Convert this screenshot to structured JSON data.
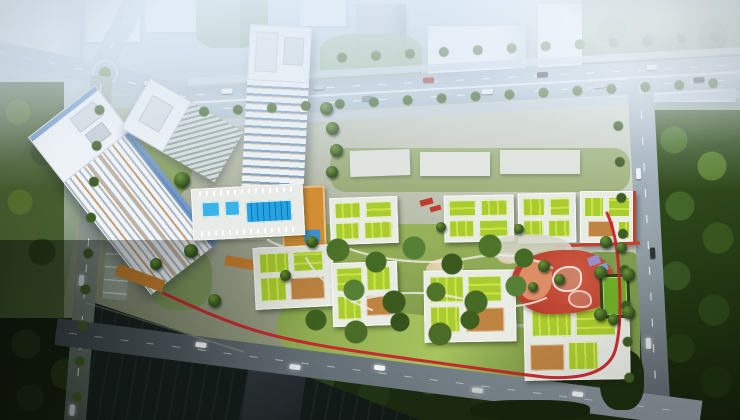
{
  "scene": {
    "type": "aerial-architectural-rendering",
    "description": "Bird's-eye architectural rendering of a residential development: high-rise towers at the north-west, two rows of mid-rise blocks with lime-green roof gardens, a swimming-pool amenity deck, an orange courtyard, a red organic-shaped playground with a green sports court, and a red jogging track looping the gardens; the site is bounded by tree-lined arterial roads with traffic, hazy city blocks to the north, dense forest to the east and a dark lake at the south-west.",
    "features": [
      "background-city-blocks",
      "north-arterial-road",
      "roundabout",
      "west-road",
      "south-road",
      "east-road",
      "high-rise-slab-tower",
      "white-roof-tower",
      "center-tower",
      "swimming-pool-deck",
      "orange-courtyard",
      "green-roof-residential-blocks",
      "central-garden",
      "sand-play-mounds",
      "red-playground",
      "purple-courts",
      "sports-court",
      "jogging-track",
      "lake",
      "dark-office-building",
      "east-forest",
      "west-park",
      "street-trees",
      "cars"
    ]
  },
  "palette": {
    "sky_haze": "#dce9f4",
    "distant_building_light": "#eef2f7",
    "distant_building_shade": "#c0cedd",
    "background_hill_green": "#9db4a0",
    "road_light": "#b4c2cf",
    "road_shade": "#525c63",
    "lane_marking": "#f2f6f9",
    "sidewalk": "#ced9e2",
    "site_ground_light": "#e0e2d9",
    "site_ground_dark": "#5a644c",
    "tower_facade": "#f2f5f8",
    "facade_stripe": "#aeb9c2",
    "tower_glass_blue": "#4a7ab5",
    "tower_accent_tan": "#c59a66",
    "block_white": "#e9ece4",
    "roof_green": "#a9cd2e",
    "roof_green_light": "#cde24a",
    "roof_tan": "#bf8442",
    "pool_blue": "#25a3e0",
    "pool_lane": "#0f6fb6",
    "deck_orange": "#d28e33",
    "accent_tile_blue": "#3f8fc9",
    "play_red": "#b9402f",
    "play_salmon": "#dd8e66",
    "court_purple": "#9b8ec4",
    "sports_green": "#71ad27",
    "track_red": "#c8232b",
    "garden_green": "#8aa64f",
    "lawn_lime": "#a7c45e",
    "tree_light": "#6d9436",
    "tree_dark": "#2f4d1c",
    "forest_green": "#3c5a24",
    "forest_deep": "#141f09",
    "park_olive": "#465d2e",
    "sand": "#d9c9a2",
    "water_dark": "#131b19",
    "dark_building": "#272c30",
    "car_white": "#f2f4f6",
    "car_dark": "#2e3438",
    "car_red": "#b23a2e"
  }
}
